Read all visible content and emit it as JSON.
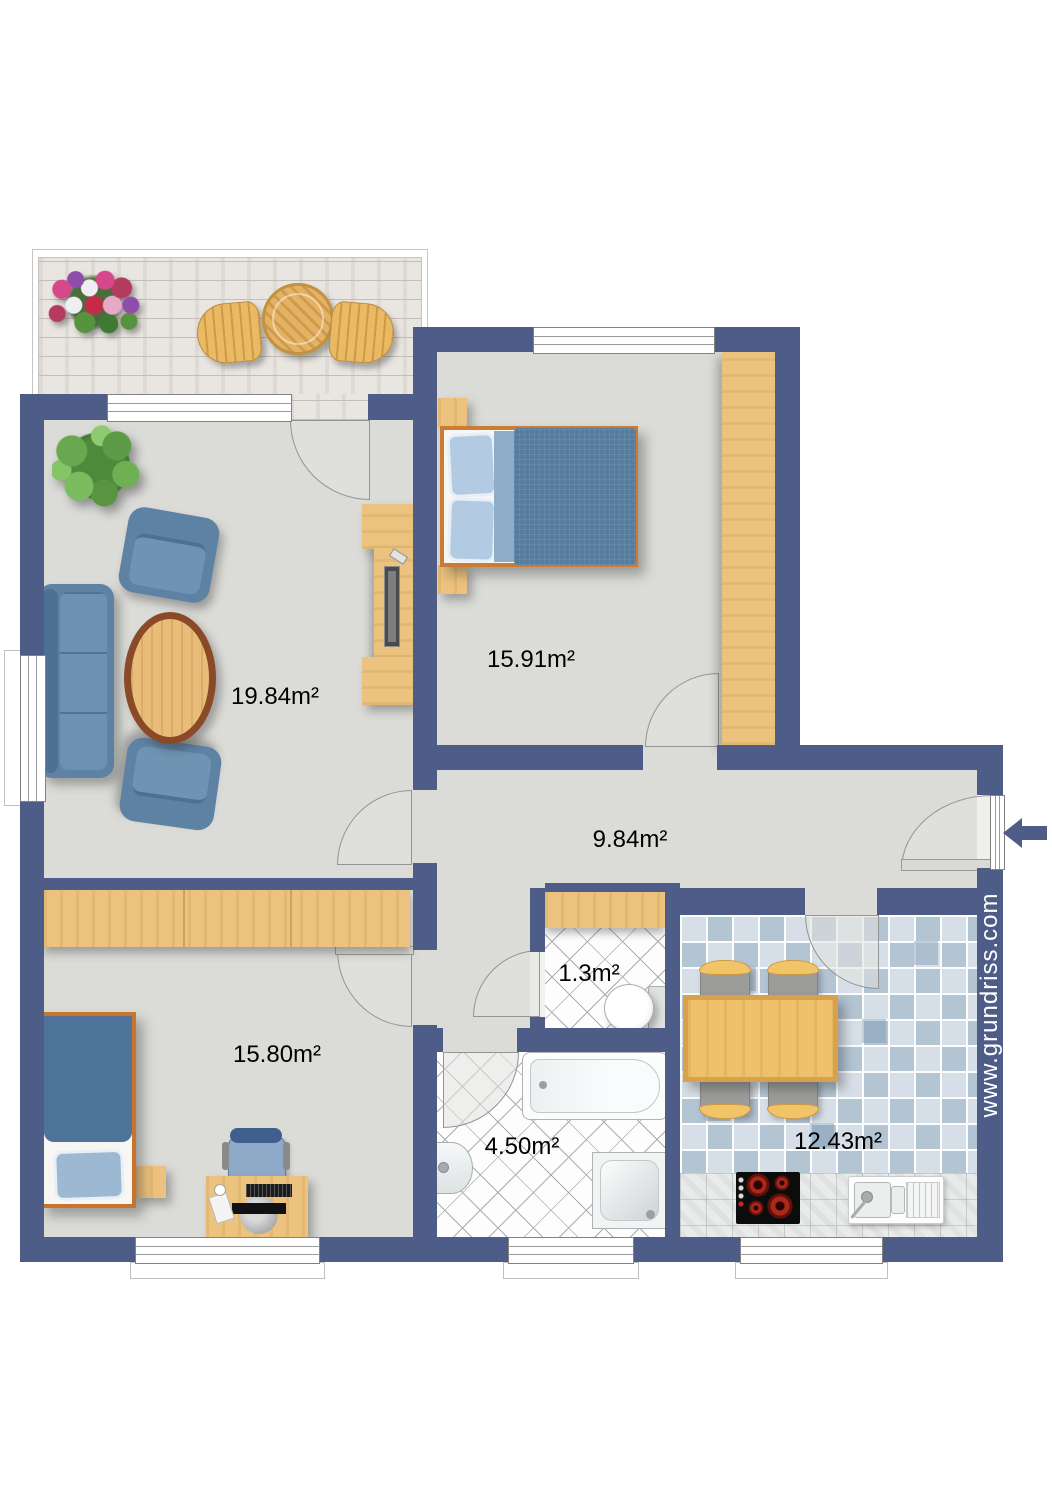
{
  "plan": {
    "watermark": "www.grundriss.com",
    "rooms": {
      "living_room": {
        "area": "19.84m²"
      },
      "bedroom_1": {
        "area": "15.91m²"
      },
      "hallway": {
        "area": "9.84m²"
      },
      "wc": {
        "area": "1.3m²"
      },
      "bedroom_2": {
        "area": "15.80m²"
      },
      "bathroom": {
        "area": "4.50m²"
      },
      "kitchen": {
        "area": "12.43m²"
      }
    },
    "colors": {
      "wall": "#4e5d88",
      "floor": "#dbdbd8",
      "wood": "#ecc37e",
      "kitchen_tile": "#b3c4d3",
      "furniture_blue": "#5e82a4",
      "burner_red": "#a8281a"
    }
  }
}
